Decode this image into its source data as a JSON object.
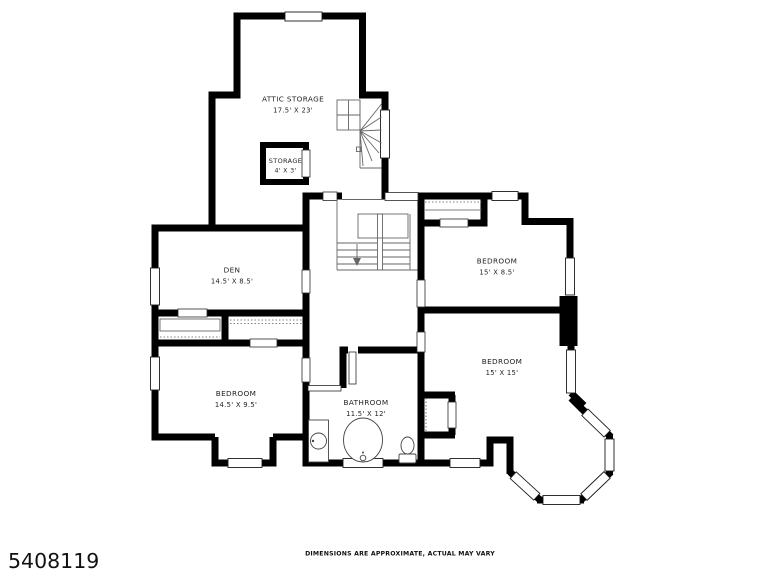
{
  "plan": {
    "type": "second-floor residential floor plan",
    "colors": {
      "wall": "#000000",
      "background": "#ffffff",
      "text": "#1f1f1f"
    },
    "rooms": [
      {
        "id": "attic-storage",
        "name": "ATTIC STORAGE",
        "dims": "17.5' X 23'"
      },
      {
        "id": "storage-closet",
        "name": "STORAGE",
        "dims": "4' X 3'"
      },
      {
        "id": "den",
        "name": "DEN",
        "dims": "14.5' X 8.5'"
      },
      {
        "id": "bedroom-upper-right",
        "name": "BEDROOM",
        "dims": "15' X 8.5'"
      },
      {
        "id": "bedroom-right",
        "name": "BEDROOM",
        "dims": "15' X 15'"
      },
      {
        "id": "bedroom-lower-left",
        "name": "BEDROOM",
        "dims": "14.5' X 9.5'"
      },
      {
        "id": "bathroom",
        "name": "BATHROOM",
        "dims": "11.5' X 12'"
      }
    ],
    "features": [
      "winder staircase to attic",
      "main U staircase with landing",
      "bay window",
      "chimney",
      "bathtub",
      "vanity sink",
      "toilet",
      "closets with shelves"
    ]
  },
  "footer": {
    "photo_id": "5408119",
    "disclaimer": "DIMENSIONS ARE APPROXIMATE, ACTUAL MAY VARY"
  }
}
